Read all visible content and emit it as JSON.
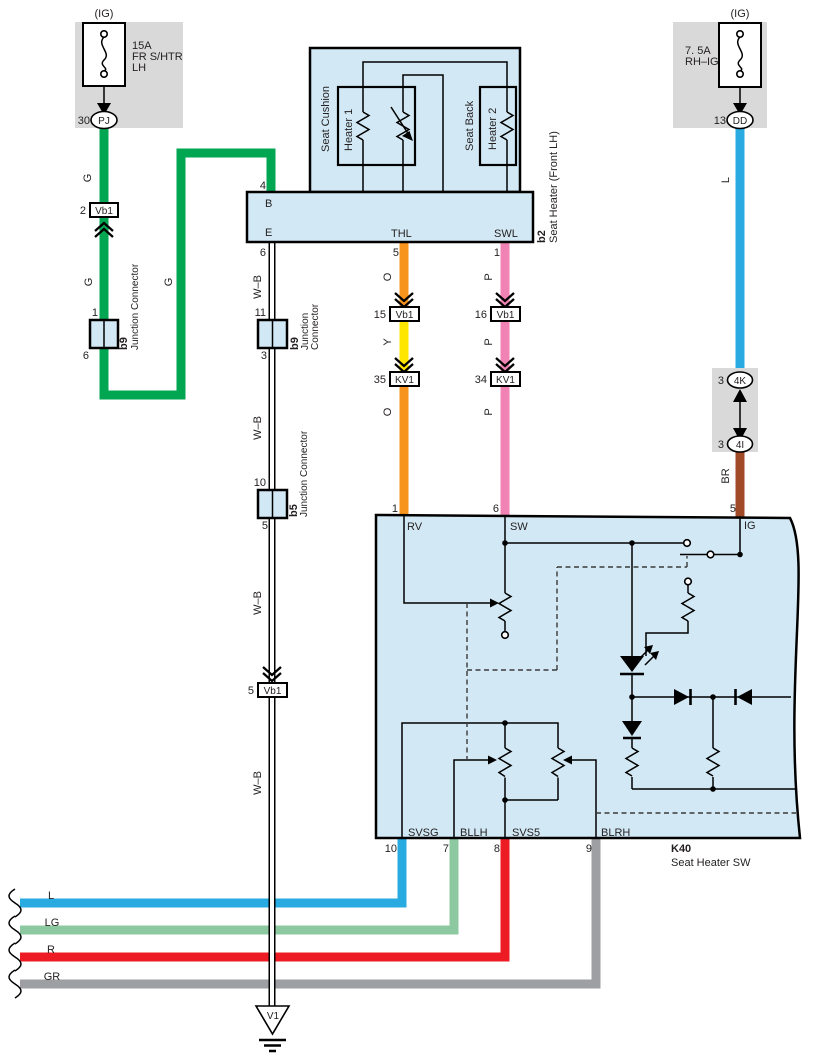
{
  "colors": {
    "green": "#00a651",
    "blue": "#29abe2",
    "pink": "#f082b4",
    "orange": "#f7941e",
    "yellow": "#ffe600",
    "brown": "#a04a28",
    "light_green": "#8cc9a0",
    "red": "#ed1c24",
    "gray": "#9d9fa2",
    "component_fill": "#d2e9f5"
  },
  "fuse_left": {
    "tag": "(IG)",
    "rating": "15A",
    "name_line1": "FR S/HTR",
    "name_line2": "LH",
    "pin": "30",
    "connector": "PJ"
  },
  "fuse_right": {
    "tag": "(IG)",
    "rating": "7. 5A",
    "name_line1": "RH–IG",
    "pin": "13",
    "connector": "DD"
  },
  "seat_heater": {
    "code": "b2",
    "name": "Seat Heater (Front LH)",
    "cushion": "Seat Cushion",
    "heater1": "Heater 1",
    "back": "Seat Back",
    "heater2": "Heater 2",
    "term_b": "B",
    "term_e": "E",
    "term_thl": "THL",
    "term_swl": "SWL",
    "pin_b": "4",
    "pin_e": "6",
    "pin_thl": "5",
    "pin_swl": "1"
  },
  "k40": {
    "code": "K40",
    "name": "Seat Heater SW",
    "term_rv": "RV",
    "term_sw": "SW",
    "term_ig": "IG",
    "term_svsg": "SVSG",
    "term_bllh": "BLLH",
    "term_svs5": "SVS5",
    "term_blrh": "BLRH",
    "pin_rv": "1",
    "pin_sw": "6",
    "pin_ig": "5",
    "pin_svsg": "10",
    "pin_bllh": "7",
    "pin_svs5": "8",
    "pin_blrh": "9"
  },
  "junctions": {
    "b9_left": {
      "code": "b9",
      "name": "Junction Connector",
      "pin_top": "1",
      "pin_bottom": "6"
    },
    "b9_mid": {
      "code": "b9",
      "name_line1": "Junction",
      "name_line2": "Connector",
      "pin_top": "11",
      "pin_bottom": "3"
    },
    "b5": {
      "code": "b5",
      "name": "Junction Connector",
      "pin_top": "10",
      "pin_bottom": "5"
    }
  },
  "inline_connectors": {
    "green_vb1": {
      "pin": "2",
      "label": "Vb1"
    },
    "wb_vb1": {
      "pin": "5",
      "label": "Vb1"
    },
    "thl_vb1": {
      "pin": "15",
      "label": "Vb1"
    },
    "thl_kv1": {
      "pin": "35",
      "label": "KV1"
    },
    "swl_vb1": {
      "pin": "16",
      "label": "Vb1"
    },
    "swl_kv1": {
      "pin": "34",
      "label": "KV1"
    },
    "right_4k": {
      "pin": "3",
      "label": "4K"
    },
    "right_4i": {
      "pin": "3",
      "label": "4I"
    }
  },
  "wire_labels": {
    "g": "G",
    "wb": "W–B",
    "o": "O",
    "y": "Y",
    "p": "P",
    "l": "L",
    "br": "BR"
  },
  "bottom_wires": [
    {
      "label": "L"
    },
    {
      "label": "LG"
    },
    {
      "label": "R"
    },
    {
      "label": "GR"
    }
  ],
  "ground": {
    "label": "V1"
  }
}
